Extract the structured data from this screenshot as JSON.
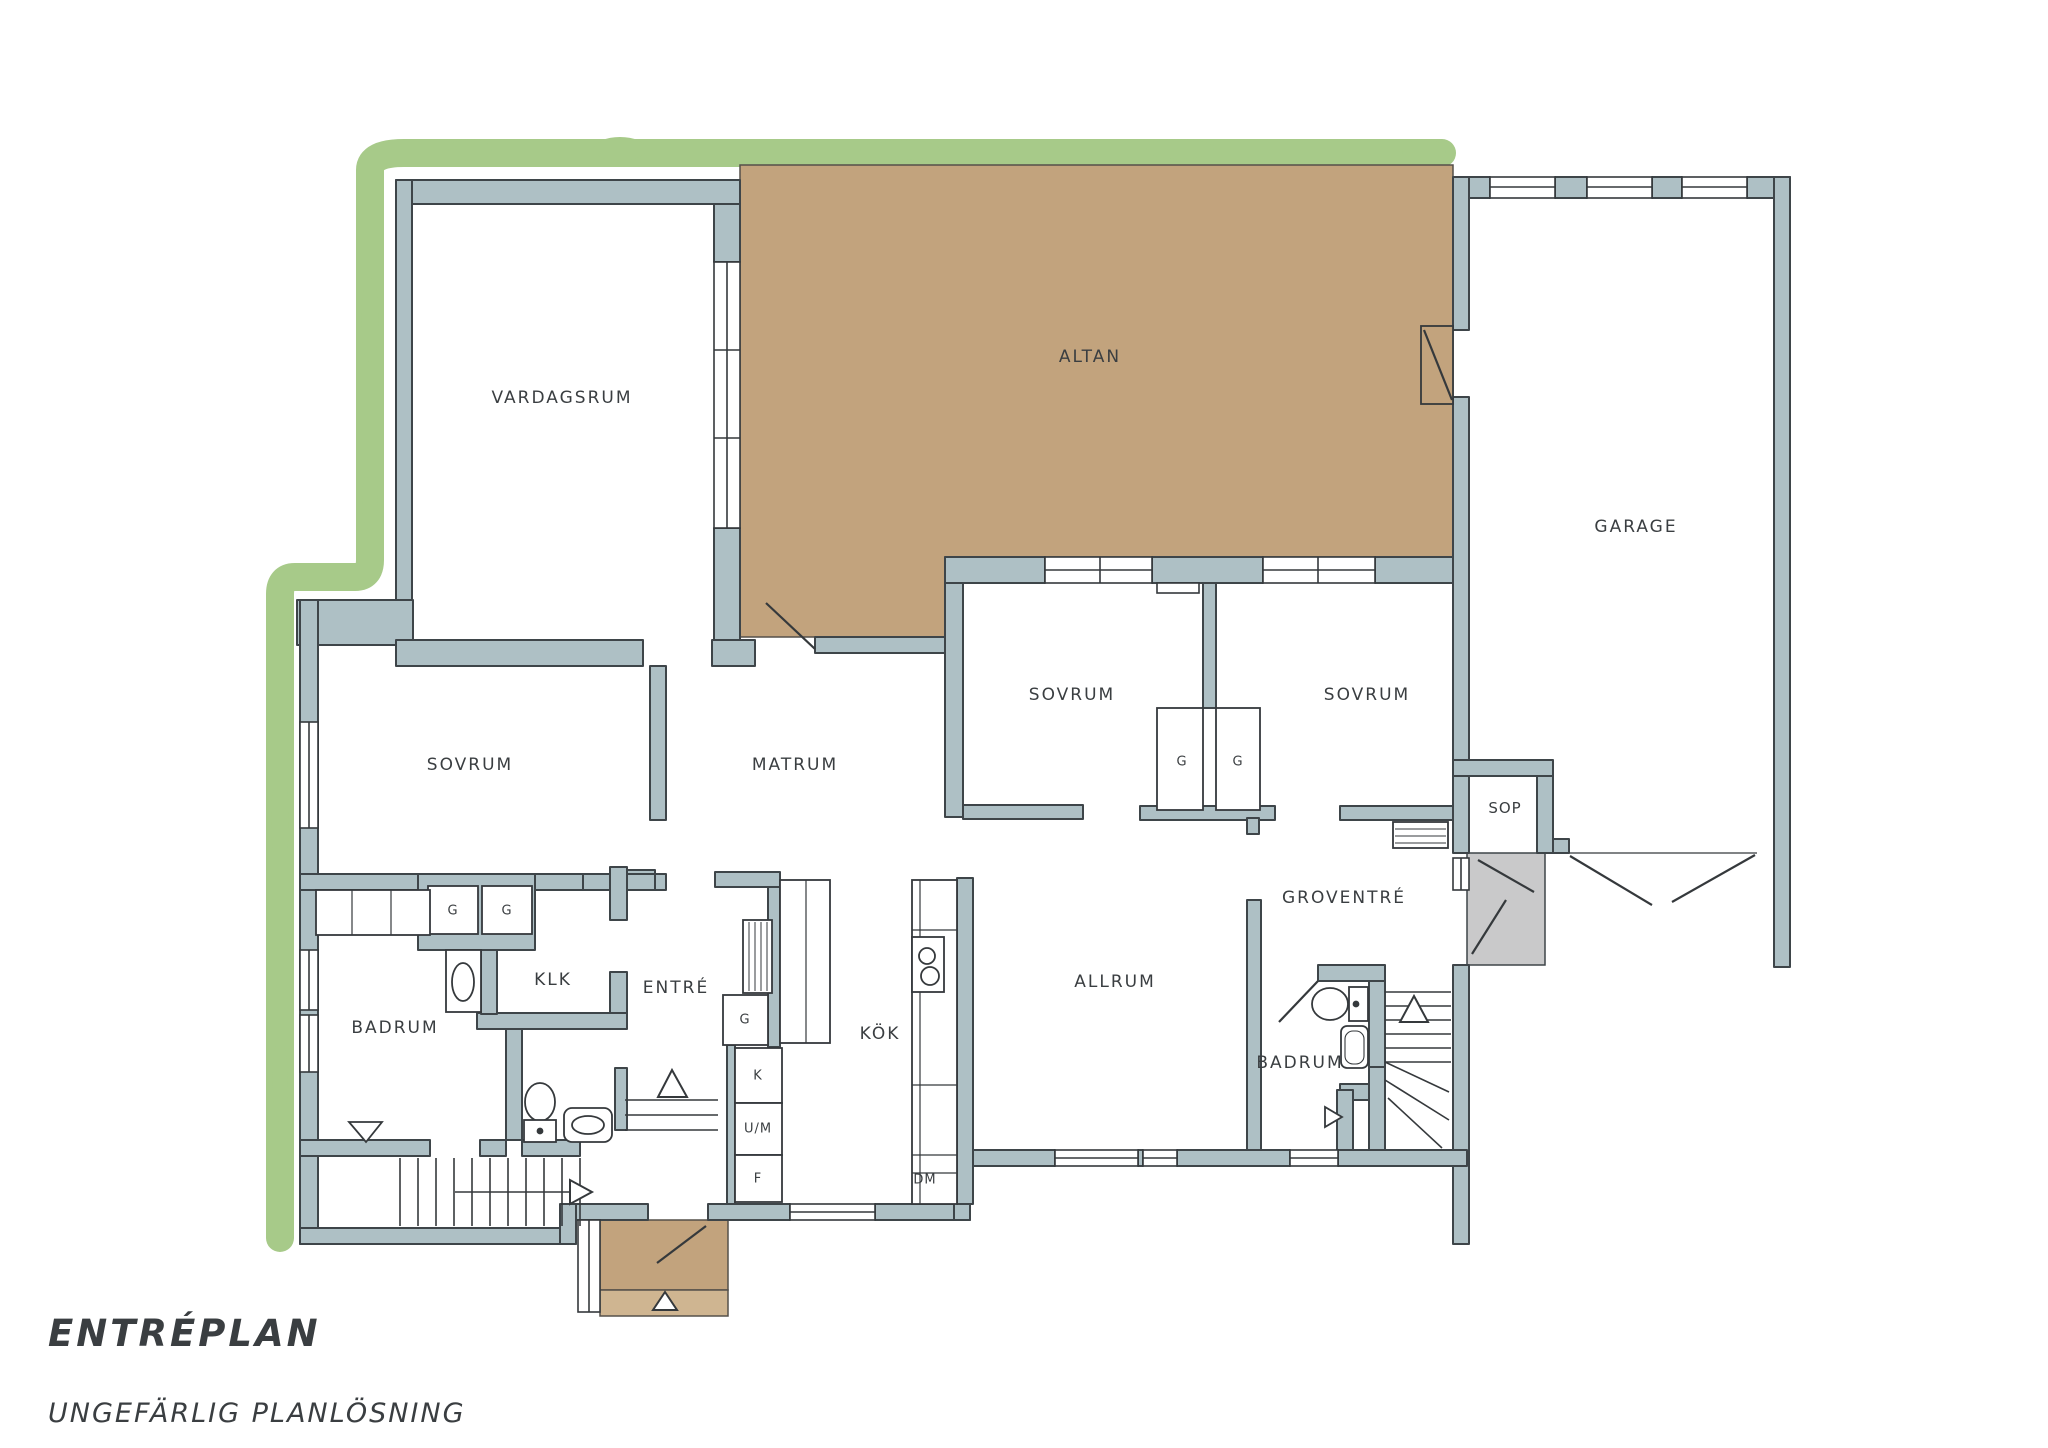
{
  "colors": {
    "wall": "#aec0c5",
    "wall_outline": "#3e4549",
    "garden": "#a7ca89",
    "terrace": "#c2a37d",
    "terrace_light": "#cfb591",
    "entry_porch": "#c9c9ca",
    "line": "#35393c",
    "text": "#3a3e41",
    "background": "#ffffff"
  },
  "title": {
    "heading": "ENTRÉPLAN",
    "subheading": "UNGEFÄRLIG PLANLÖSNING"
  },
  "labels": {
    "vardagsrum": "VARDAGSRUM",
    "altan": "ALTAN",
    "garage": "GARAGE",
    "sovrum": "SOVRUM",
    "matrum": "MATRUM",
    "allrum": "ALLRUM",
    "kok": "KÖK",
    "entre": "ENTRÉ",
    "klk": "KLK",
    "badrum": "BADRUM",
    "groventre": "GROVENTRÉ",
    "sop": "SOP",
    "garderob": "G",
    "kyl": "K",
    "ugn_micro": "U/M",
    "frys": "F",
    "diskmaskin": "DM"
  }
}
